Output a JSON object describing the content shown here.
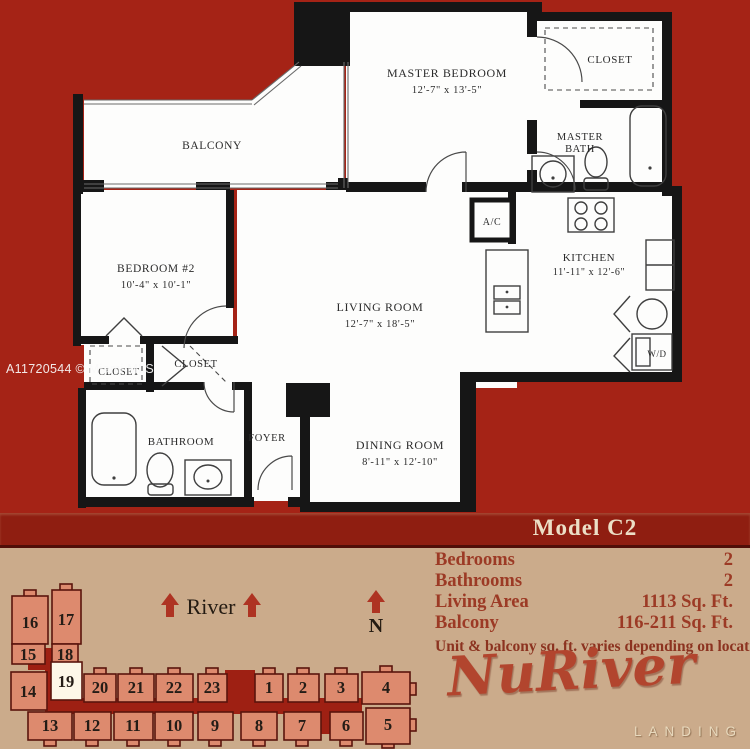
{
  "floorplan": {
    "watermark": "A11720544 © Miami MLS",
    "model_label": "Model C2",
    "rooms": {
      "balcony": "BALCONY",
      "master_bedroom": "MASTER BEDROOM",
      "master_bedroom_dims": "12'-7\" x 13'-5\"",
      "master_closet": "CLOSET",
      "master_bath_line1": "MASTER",
      "master_bath_line2": "BATH",
      "bedroom2": "BEDROOM #2",
      "bedroom2_dims": "10'-4\" x 10'-1\"",
      "ac": "A/C",
      "kitchen": "KITCHEN",
      "kitchen_dims": "11'-11\" x 12'-6\"",
      "living_room": "LIVING ROOM",
      "living_room_dims": "12'-7\" x 18'-5\"",
      "washer_dryer": "W/D",
      "closet_hall": "CLOSET",
      "closet_bedroom2": "CLOSET",
      "bathroom": "BATHROOM",
      "foyer": "FOYER",
      "dining_room": "DINING ROOM",
      "dining_room_dims": "8'-11\" x 12'-10\""
    }
  },
  "details": {
    "rows": [
      {
        "label": "Bedrooms",
        "value": "2"
      },
      {
        "label": "Bathrooms",
        "value": "2"
      },
      {
        "label": "Living Area",
        "value": "1113 Sq. Ft."
      },
      {
        "label": "Balcony",
        "value": "116-211 Sq. Ft."
      }
    ],
    "note": "Unit & balcony sq. ft. varies depending on location."
  },
  "siteplan": {
    "river_label": "River",
    "north_label": "N",
    "highlighted_unit": "19",
    "units": [
      "16",
      "17",
      "15",
      "18",
      "19",
      "14",
      "20",
      "21",
      "22",
      "23",
      "1",
      "2",
      "3",
      "4",
      "13",
      "12",
      "11",
      "10",
      "9",
      "8",
      "7",
      "6",
      "5"
    ]
  },
  "logo": {
    "name": "NuRiver",
    "subtitle": "LANDING"
  },
  "colors": {
    "background_red": "#a52316",
    "model_band_red": "#8f1e11",
    "background_tan": "#cbab8b",
    "unit_fill": "#dd8a6e",
    "unit_outline": "#5a140c",
    "unit_highlight": "#fdf7e8",
    "corridor_red": "#9e2013",
    "accent_red": "#ae3322",
    "info_text_red": "#9c3a25",
    "model_text_cream": "#ecdfc6",
    "logo_red": "#b2452e",
    "logo_subtitle_cream": "#e8d9bd",
    "plan_wall_black": "#161616"
  }
}
